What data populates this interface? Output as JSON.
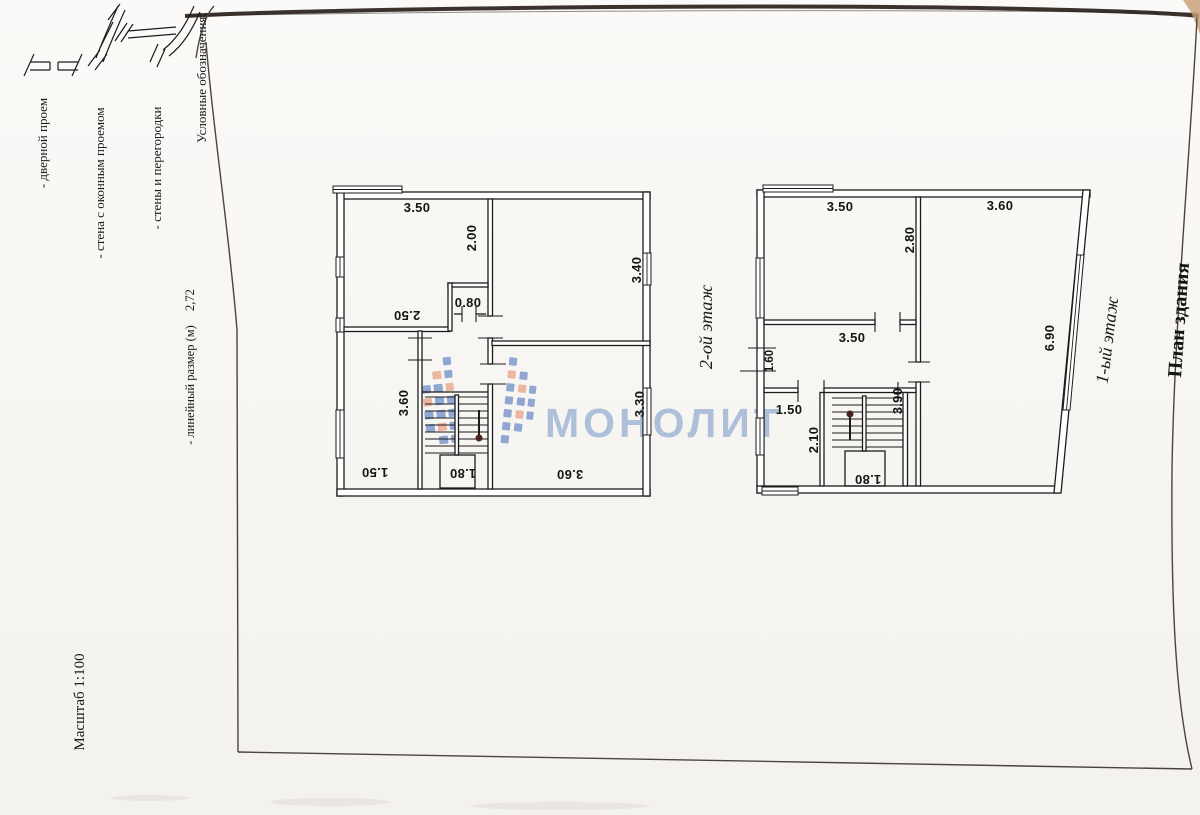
{
  "colors": {
    "ink": "#1c1c1c",
    "frame": "#4b433e",
    "scan": "#2a211c",
    "tan": "#c79e74",
    "wm": "#aebfd9",
    "tile-blue": "#7e9acd",
    "tile-salmon": "#edab93",
    "dot": "#4a241c",
    "dim": "#141414",
    "page": "#f8f6f3"
  },
  "page": {
    "title": "План здания",
    "scale": "Масштаб 1:100"
  },
  "watermark": {
    "text": "МОНОЛИТ"
  },
  "legend": {
    "title": "Условные обозначения:",
    "wall_item": "- стены и перегородки",
    "window_item": "- стена с оконным проемом",
    "door_item": "- дверной проем",
    "dim_example": "2,72",
    "dim_note": "- линейный размер (м)"
  },
  "floors": [
    {
      "label": "2-ой этаж",
      "dims": {
        "top_width": "3.50",
        "hall_width": "2.00",
        "doorway": "0.80",
        "tl_depth": "2.50",
        "tr_height": "3.40",
        "bl_height": "3.60",
        "bl_width": "1.50",
        "stairs": "1.80",
        "br_width": "3.60",
        "br_height": "3.30"
      }
    },
    {
      "label": "1-ый этаж",
      "dims": {
        "tl_width": "3.50",
        "tr_width": "3.60",
        "tl_height": "2.80",
        "mid_width": "3.50",
        "left_opening": "1.60",
        "right_height": "6.90",
        "door": "1.50",
        "bl_height": "2.10",
        "stairwell": "3.90",
        "stairs": "1.80"
      }
    }
  ]
}
